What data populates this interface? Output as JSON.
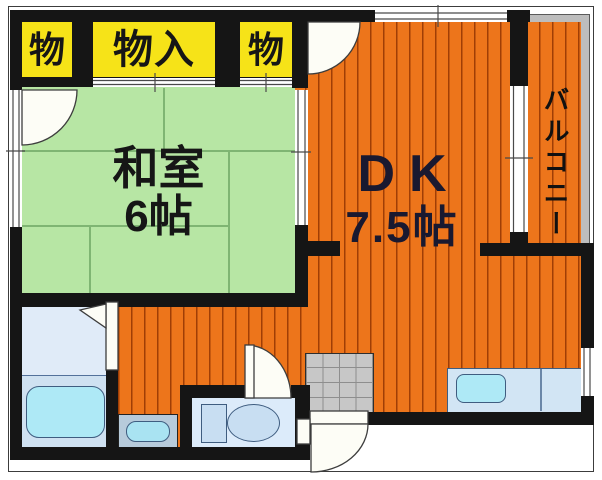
{
  "floor_plan": {
    "closets": {
      "left": "物",
      "center": "物入",
      "right": "物"
    },
    "tatami_room": {
      "name": "和室",
      "size": "6帖"
    },
    "dining_kitchen": {
      "name": "DK",
      "size": "7.5帖"
    },
    "balcony": {
      "name": "バルコニー"
    },
    "colors": {
      "closet_bg": "#f6e318",
      "tatami_floor": "#b7e6a4",
      "dk_floor": "#ed751b",
      "balcony": "#bdbdbd",
      "wall": "#151515",
      "water_fixtures": "#aee9f6"
    },
    "fixtures": [
      "bathtub",
      "washbasin",
      "toilet",
      "entrance-tile",
      "kitchen-counter-sink"
    ]
  }
}
